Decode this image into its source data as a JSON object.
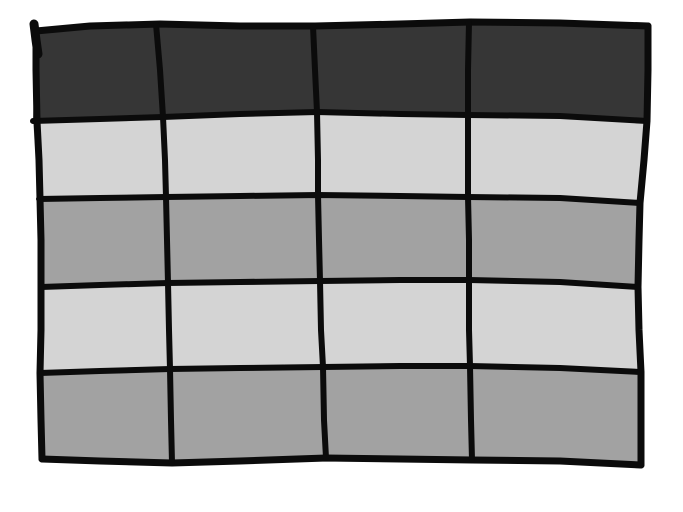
{
  "figure": {
    "kind": "hand-drawn-table-sketch",
    "rows": 5,
    "columns": 4,
    "has_text": false,
    "row_tones": [
      "header",
      "light",
      "medium",
      "light",
      "medium"
    ],
    "colors": {
      "header": "#363636",
      "light": "#d4d4d4",
      "medium": "#a2a2a2",
      "border": "#0b0b0b",
      "background": "#ffffff"
    }
  }
}
